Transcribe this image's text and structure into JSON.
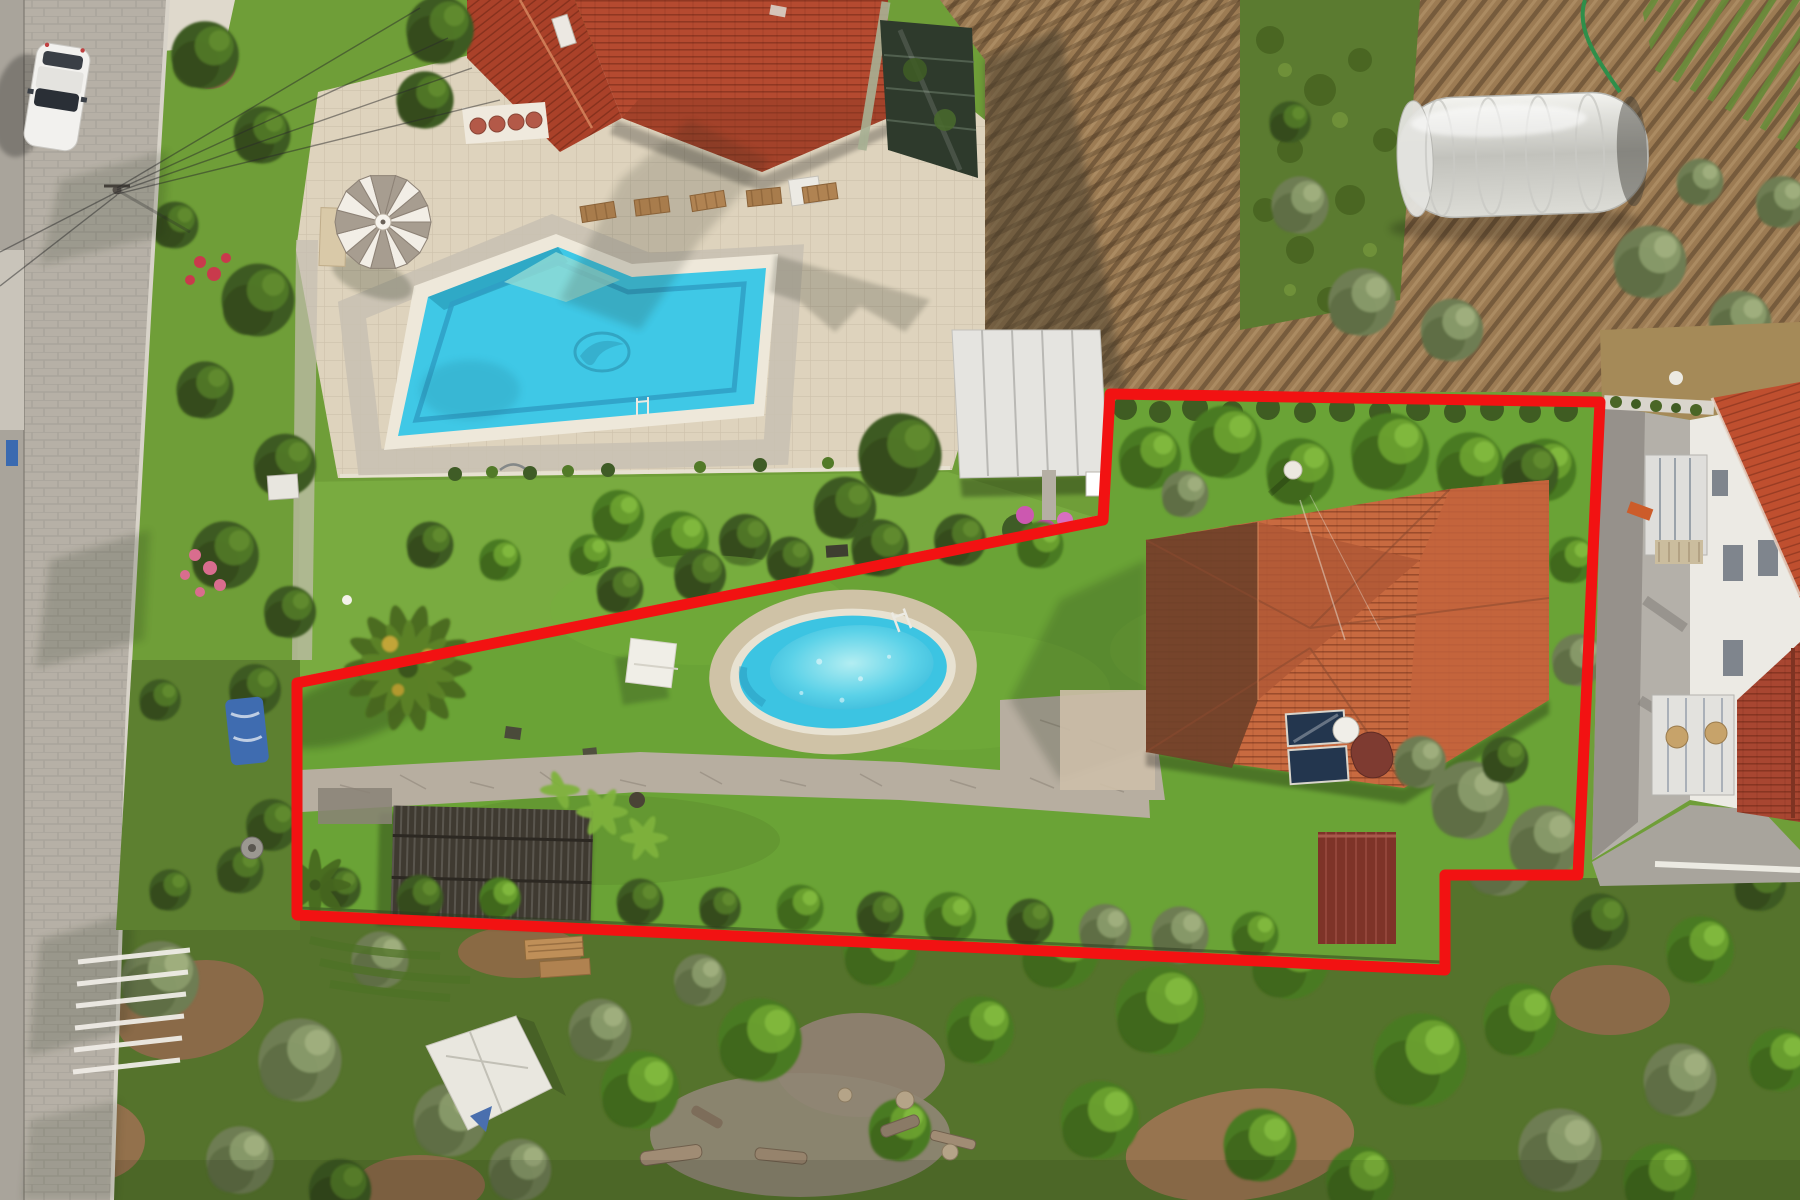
{
  "meta": {
    "image_type": "aerial-drone-photograph",
    "subject": "Detached villa with garden, oval pool and outbuildings, marked with a red property-boundary outline; neighbouring villa with large pool at top-left, street on the left, farmland with greenhouse tunnel at top-right, woodland at the bottom, white apartment block on the right"
  },
  "boundary": {
    "points": "1110,394 1600,402 1578,875 1445,875 1445,970 297,915 297,683 1103,520",
    "color": "#f21212",
    "stroke_width": 11
  },
  "colors": {
    "grass": "#6f9e38",
    "lawn_top_property": "#79ab40",
    "lawn_inside_boundary": "#6aa336",
    "street": "#b6b0a6",
    "patio": "#ded3bd",
    "pool_water": "#3fc8e6",
    "pool_lane": "#2f9fc4",
    "pool_shelf": "#93dcd4",
    "oval_pool_water": "#3cc4e2",
    "oval_pool_stone": "#cfc2a6",
    "house_roof": "#b54a30",
    "villa_roof": "#c86a40",
    "villa_roof_shade": "#6f4129",
    "farmland": "#9c7b53",
    "crop_rows_green": "#5b7b30",
    "greenhouse": "#e0e0db",
    "shed_roof": "#3f3a31",
    "garage_roof": "#7e3328",
    "woodland": "#55732c",
    "white_building": "#eceae4",
    "neighbor_roof": "#bf4f2f",
    "umbrella_gray": "#a79d90",
    "umbrella_white": "#f2eee6",
    "solar_panel": "#23364e",
    "boundary_red": "#f21212"
  },
  "scene": {
    "street": {
      "label": "cobbled street with parked white car, power pole and overhead wires",
      "car_color": "#f2f1ee"
    },
    "top_left_property": {
      "label": "neighbouring villa with red tiled roof, beige pool terrace, striped parasol, sun loungers and rectangular pool with dolphin mosaic"
    },
    "marked_property": {
      "label": "villa with hipped terracotta roof, solar water heater, satellite dish, lawn, oval pool, palm tree, flagstone path and corrugated shed"
    },
    "top_right": {
      "label": "ploughed field with crop rows, plastic greenhouse tunnel, garden hose and olive trees"
    },
    "right_side": {
      "label": "concrete alley and white multi-storey apartment building with glazed balconies and terracotta roofs"
    },
    "bottom": {
      "label": "olive and fig woodland with white tarpaulin, timber pallets and log piles"
    }
  }
}
